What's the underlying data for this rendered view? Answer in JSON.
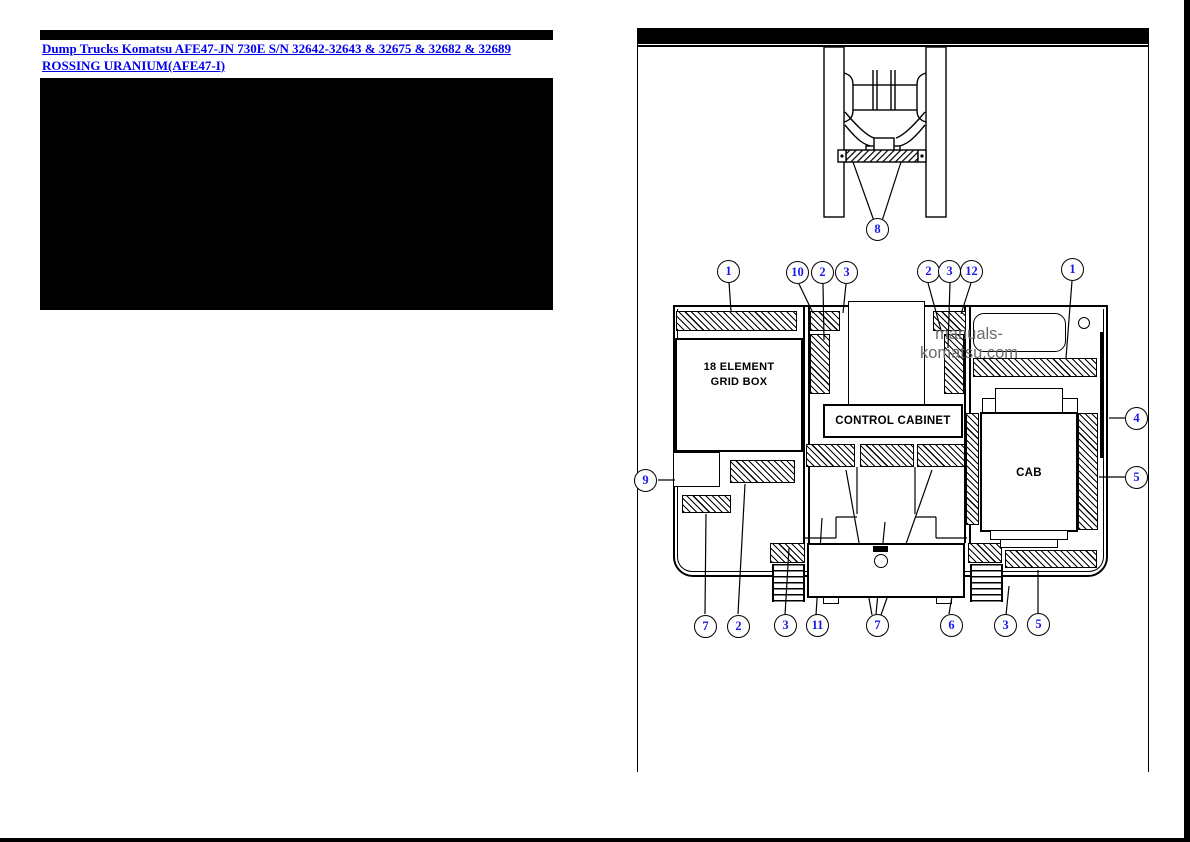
{
  "colors": {
    "link_blue": "#0000EE",
    "callout_blue": "#1a1ae6",
    "watermark_gray": "#6b6b6b",
    "panel_black": "#000000"
  },
  "left_panel": {
    "link_text": "Dump Trucks Komatsu AFE47-JN 730E S/N 32642-32643 & 32675 & 32682 & 32689 ROSSING URANIUM(AFE47-I)"
  },
  "diagram": {
    "watermark": "manuals-komatsu.com",
    "labels": {
      "grid_box_line1": "18 ELEMENT",
      "grid_box_line2": "GRID BOX",
      "control_cabinet": "CONTROL CABINET",
      "cab": "CAB"
    },
    "callouts": [
      "8",
      "1",
      "10",
      "2",
      "3",
      "2",
      "3",
      "12",
      "1",
      "9",
      "4",
      "5",
      "7",
      "2",
      "3",
      "11",
      "7",
      "6",
      "3",
      "5"
    ]
  }
}
